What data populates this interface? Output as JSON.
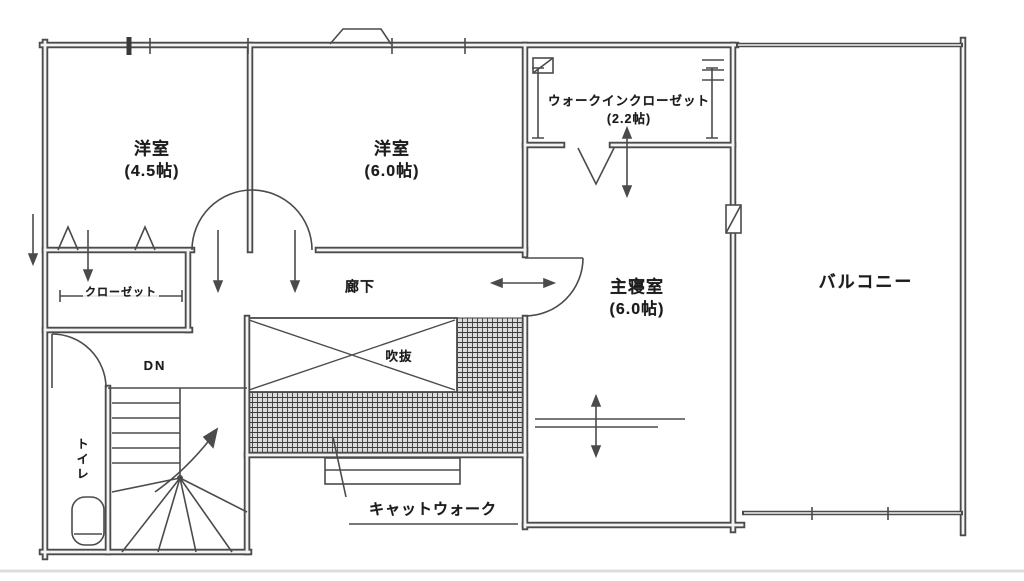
{
  "plan": {
    "rooms": {
      "bedroom1": {
        "name": "洋室",
        "size": "(4.5帖)"
      },
      "bedroom2": {
        "name": "洋室",
        "size": "(6.0帖)"
      },
      "wic": {
        "name": "ウォークインクローゼット",
        "size": "(2.2帖)"
      },
      "master": {
        "name": "主寝室",
        "size": "(6.0帖)"
      },
      "balcony": {
        "name": "バルコニー"
      },
      "closet": {
        "name": "クローゼット"
      },
      "hallway": {
        "name": "廊下"
      },
      "void": {
        "name": "吹抜"
      },
      "toilet": {
        "name": "トイレ"
      }
    },
    "annotations": {
      "stairs_down": "DN",
      "catwalk": "キャットウォーク"
    },
    "colors": {
      "line": "#4b4b4b",
      "background": "#ffffff",
      "hatch_line": "#3c3c3c",
      "hatch_bg": "#dcdcdc"
    }
  }
}
